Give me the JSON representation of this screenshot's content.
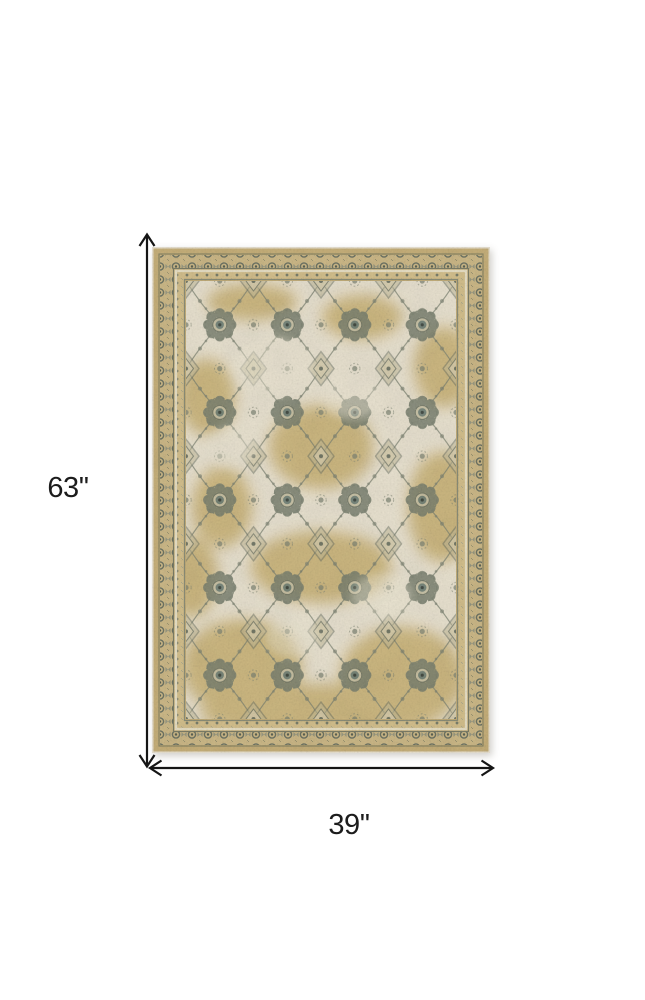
{
  "page": {
    "background_color": "#ffffff"
  },
  "product_image": {
    "alt": "Beige and gray traditional distressed oriental area rug, overhead view",
    "colors": {
      "border_tan": "#c7b07a",
      "border_pattern_base": "#cdb988",
      "field_ivory": "#e9e2d0",
      "gold_patch": "#cbb479",
      "motif_gray_green": "#79806f",
      "accent_teal": "#6f8076",
      "cream_line": "#e8e0c5"
    }
  },
  "dimension_annotation": {
    "height_label": "63''",
    "width_label": "39''",
    "line_color": "#151515",
    "text_color": "#1c1c1c"
  }
}
